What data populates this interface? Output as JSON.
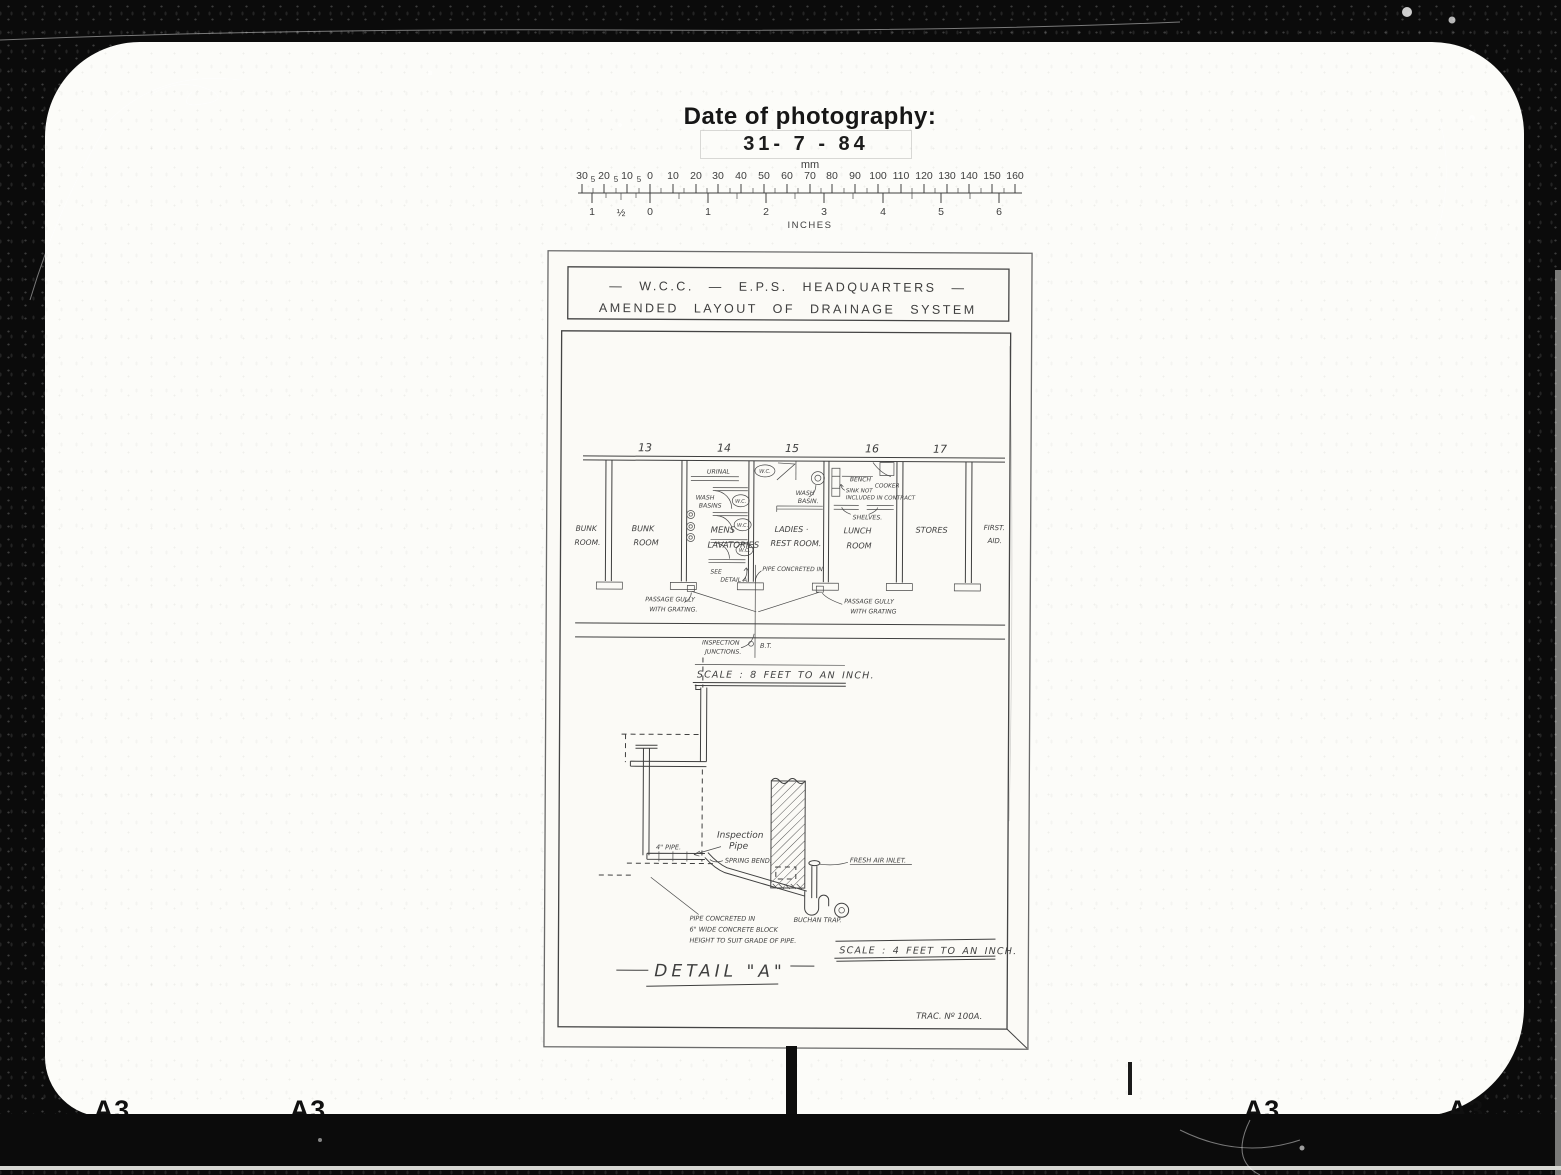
{
  "photo": {
    "date_label": "Date of photography:",
    "date_value": "31- 7 - 84",
    "frame_labels": [
      "A3",
      "A3",
      "A3",
      "A3"
    ],
    "ruler": {
      "top_unit": "mm",
      "bottom_unit": "INCHES",
      "mm_left_major": [
        "30",
        "20",
        "10"
      ],
      "mm_small": "5",
      "mm_main": [
        "0",
        "10",
        "20",
        "30",
        "40",
        "50",
        "60",
        "70",
        "80",
        "90",
        "100",
        "110",
        "120",
        "130",
        "140",
        "150",
        "160"
      ],
      "inch_left": [
        "1",
        "½"
      ],
      "inch_main": [
        "0",
        "1",
        "2",
        "3",
        "4",
        "5",
        "6"
      ]
    }
  },
  "sheet": {
    "title1": "— W.C.C. — E.P.S. HEADQUARTERS —",
    "title2": "AMENDED LAYOUT OF DRAINAGE SYSTEM",
    "trac_no": "TRAC. Nº 100A.",
    "plan": {
      "scale": "SCALE : 8 FEET TO AN INCH.",
      "grid": [
        "13",
        "14",
        "15",
        "16",
        "17"
      ],
      "rooms": {
        "bunk1": [
          "BUNK",
          "ROOM."
        ],
        "bunk2": [
          "BUNK",
          "ROOM"
        ],
        "mens": [
          "MENS",
          "LAVATORIES"
        ],
        "ladies": [
          "LADIES ·",
          "REST ROOM."
        ],
        "lunch": [
          "LUNCH",
          "ROOM"
        ],
        "stores": "STORES",
        "first_aid": [
          "FIRST.",
          "AID."
        ]
      },
      "fixtures": {
        "urinal": "URINAL",
        "wc": "W.C.",
        "wash_basins": [
          "WASH",
          "BASINS"
        ],
        "wash_basin": [
          "WASH",
          "BASIN."
        ],
        "bench": "BENCH",
        "cooker": "COOKER",
        "sink_note": [
          "SINK NOT",
          "INCLUDED IN CONTRACT"
        ],
        "shelves": "SHELVES.",
        "see_detail": [
          "SEE",
          "DETAIL A."
        ],
        "pipe_concreted": "PIPE CONCRETED IN.",
        "gully_left": [
          "PASSAGE GULLY",
          "WITH GRATING."
        ],
        "gully_right": [
          "PASSAGE GULLY",
          "WITH GRATING"
        ],
        "inspection": [
          "INSPECTION",
          "JUNCTIONS."
        ],
        "bt": "B.T."
      }
    },
    "detail": {
      "title": "DETAIL \"A\"",
      "scale": "SCALE : 4 FEET TO AN INCH.",
      "labels": {
        "inspection_pipe": [
          "Inspection",
          "Pipe"
        ],
        "four_inch_pipe": "4\" PIPE.",
        "spring_bend": "SPRING BEND.",
        "fresh_air_inlet": "FRESH AIR INLET.",
        "buchan_trap": "BUCHAN TRAP.",
        "concrete_note": [
          "PIPE CONCRETED IN",
          "6\" WIDE CONCRETE BLOCK",
          "HEIGHT TO SUIT GRADE OF PIPE."
        ]
      }
    }
  }
}
